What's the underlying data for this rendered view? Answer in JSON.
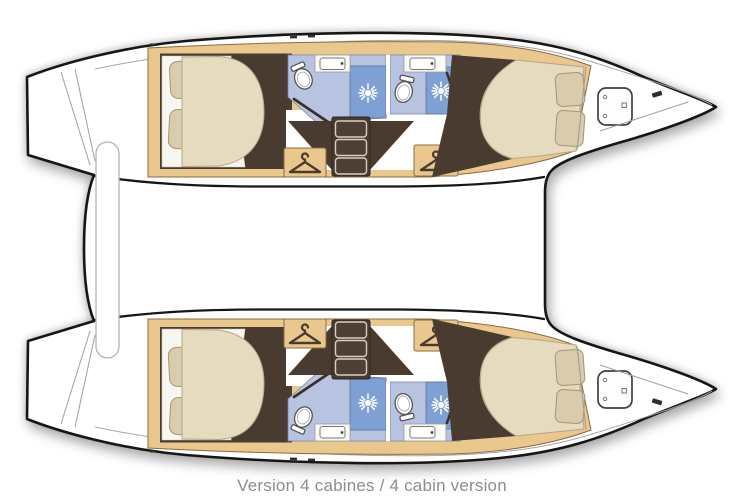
{
  "caption": {
    "text": "Version 4 cabines / 4 cabin version"
  },
  "palette": {
    "hull-outline": "#161616",
    "wood-tan": "#e9c78d",
    "floor-brown": "#4a3b31",
    "bed-cream": "#e6dabf",
    "pillow-tan": "#d9cbab",
    "bath-blue-light": "#b7c3e0",
    "bath-blue-shower": "#7fa0d2",
    "caption-gray": "#8a8e93",
    "paper-white": "#ffffff"
  },
  "boat": {
    "type": "catamaran floor plan, top view",
    "orientation": "bows pointing right, transoms at left",
    "hulls": [
      {
        "name": "upper hull",
        "rooms": [
          "aft double cabin",
          "aft bathroom with shower",
          "companionway stairs",
          "forward bathroom with shower",
          "forward double cabin",
          "bow locker with deck hatch"
        ]
      },
      {
        "name": "lower hull",
        "rooms": [
          "aft double cabin",
          "aft bathroom with shower",
          "companionway stairs",
          "forward bathroom with shower",
          "forward double cabin",
          "bow locker with deck hatch"
        ]
      }
    ],
    "icon_counts": {
      "hanger-locker-icon": 4,
      "shower-head-icon": 4,
      "toilet-icon": 4,
      "sink-icon": 4,
      "deck-hatch-icon": 2,
      "pillow": 8,
      "double-bed": 4
    }
  }
}
